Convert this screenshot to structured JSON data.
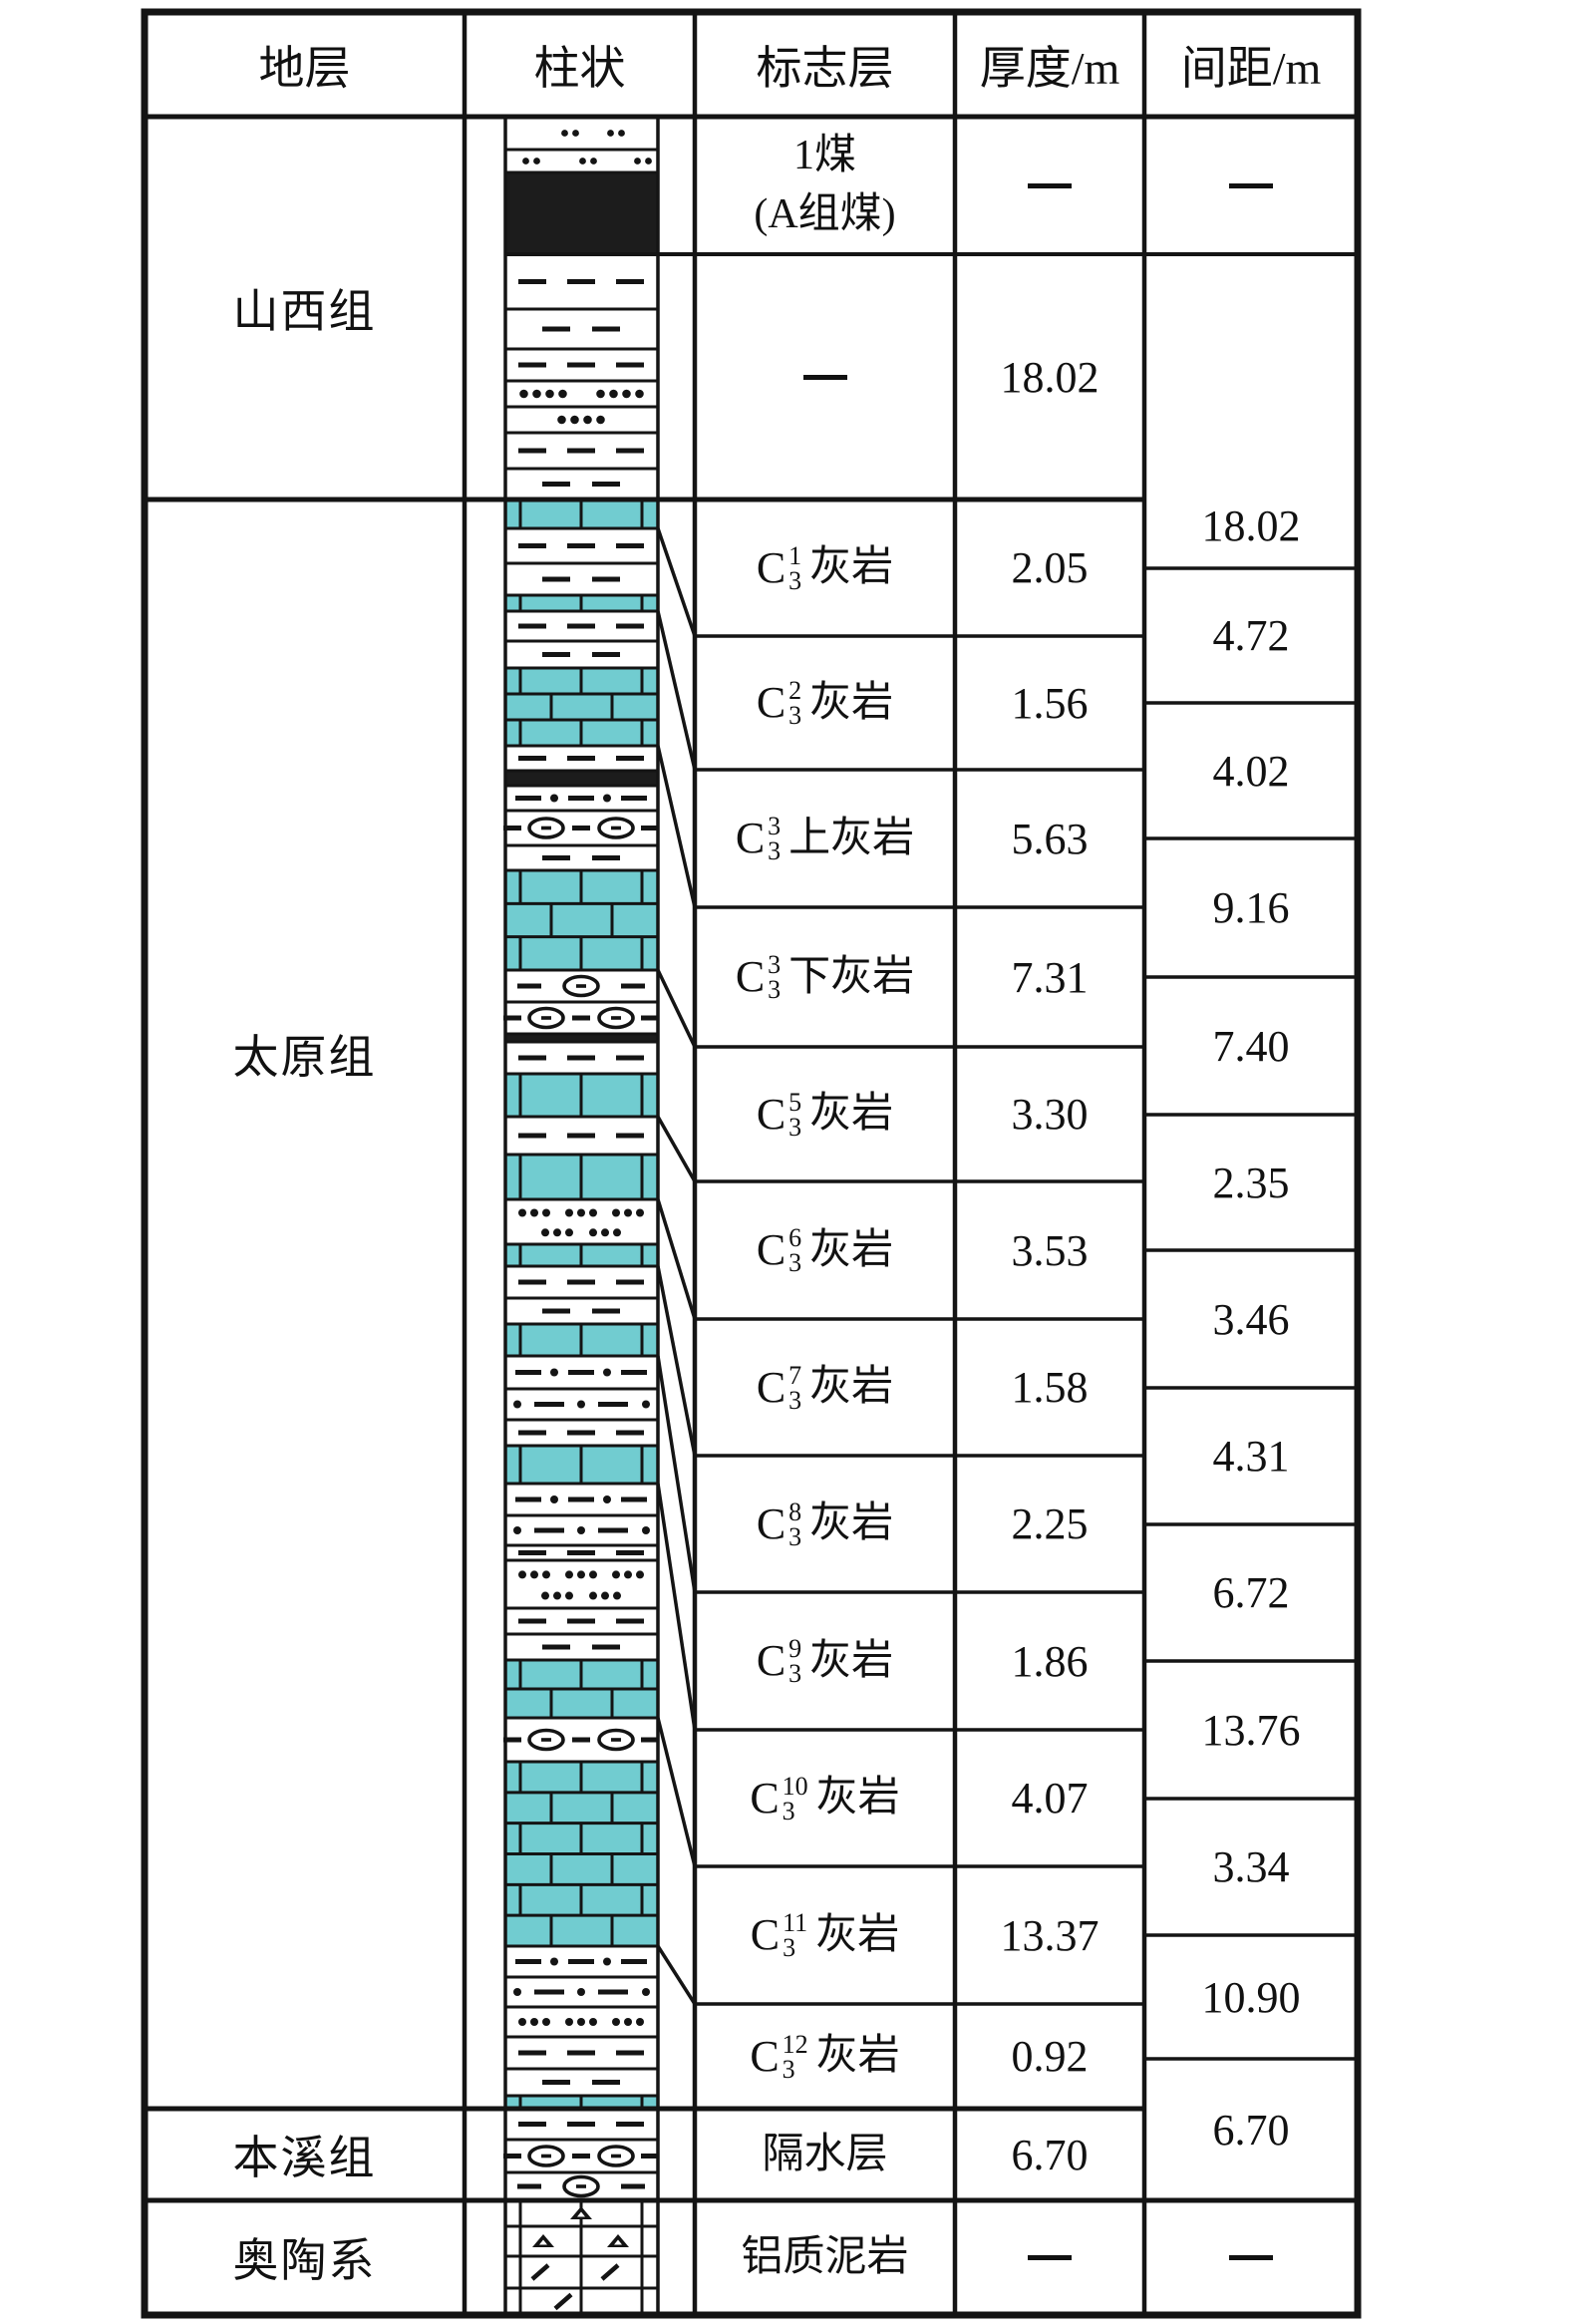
{
  "header": {
    "stratum": "地层",
    "column": "柱状",
    "marker_bed": "标志层",
    "thickness": "厚度/m",
    "spacing": "间距/m"
  },
  "colors": {
    "limestone_fill": "#71ccd0",
    "coal_fill": "#1c1c1c",
    "line": "#141414",
    "background": "#ffffff"
  },
  "chart_data": {
    "type": "stratigraphic-column-table",
    "formations": [
      {
        "name": "山西组"
      },
      {
        "name": "太原组"
      },
      {
        "name": "本溪组"
      },
      {
        "name": "奥陶系"
      }
    ],
    "marker_rows": [
      {
        "marker": "1煤",
        "marker_line2": "(A组煤)",
        "thickness_m": "—"
      },
      {
        "marker": "—",
        "thickness_m": "18.02"
      },
      {
        "c_sup": "1",
        "c_sub": "3",
        "marker": "灰岩",
        "thickness_m": "2.05"
      },
      {
        "c_sup": "2",
        "c_sub": "3",
        "marker": "灰岩",
        "thickness_m": "1.56"
      },
      {
        "c_sup": "3",
        "c_sub": "3",
        "marker": "上灰岩",
        "thickness_m": "5.63"
      },
      {
        "c_sup": "3",
        "c_sub": "3",
        "marker": "下灰岩",
        "thickness_m": "7.31"
      },
      {
        "c_sup": "5",
        "c_sub": "3",
        "marker": "灰岩",
        "thickness_m": "3.30"
      },
      {
        "c_sup": "6",
        "c_sub": "3",
        "marker": "灰岩",
        "thickness_m": "3.53"
      },
      {
        "c_sup": "7",
        "c_sub": "3",
        "marker": "灰岩",
        "thickness_m": "1.58"
      },
      {
        "c_sup": "8",
        "c_sub": "3",
        "marker": "灰岩",
        "thickness_m": "2.25"
      },
      {
        "c_sup": "9",
        "c_sub": "3",
        "marker": "灰岩",
        "thickness_m": "1.86"
      },
      {
        "c_sup": "10",
        "c_sub": "3",
        "marker": "灰岩",
        "thickness_m": "4.07"
      },
      {
        "c_sup": "11",
        "c_sub": "3",
        "marker": "灰岩",
        "thickness_m": "13.37"
      },
      {
        "c_sup": "12",
        "c_sub": "3",
        "marker": "灰岩",
        "thickness_m": "0.92"
      },
      {
        "marker": "隔水层",
        "thickness_m": "6.70"
      },
      {
        "marker": "铝质泥岩",
        "thickness_m": "—"
      }
    ],
    "spacing_m": [
      "—",
      "18.02",
      "4.72",
      "4.02",
      "9.16",
      "7.40",
      "2.35",
      "3.46",
      "4.31",
      "6.72",
      "13.76",
      "3.34",
      "10.90",
      "6.70",
      "—"
    ],
    "lithology_layers": [
      {
        "type": "sandstone-dotpair-2",
        "from": 117,
        "to": 150
      },
      {
        "type": "sandstone-dotpair-3",
        "from": 150,
        "to": 173
      },
      {
        "type": "coal",
        "from": 173,
        "to": 255
      },
      {
        "type": "mudstone-3dash",
        "from": 255,
        "to": 310
      },
      {
        "type": "mudstone-2dash",
        "from": 310,
        "to": 350
      },
      {
        "type": "mudstone-3dash",
        "from": 350,
        "to": 382
      },
      {
        "type": "sandstone-4dot-2",
        "from": 382,
        "to": 408
      },
      {
        "type": "sandstone-4dot-center",
        "from": 408,
        "to": 434
      },
      {
        "type": "mudstone-3dash",
        "from": 434,
        "to": 470
      },
      {
        "type": "mudstone-2dash",
        "from": 470,
        "to": 501
      },
      {
        "type": "limestone-brick",
        "from": 501,
        "to": 530
      },
      {
        "type": "mudstone-3dash",
        "from": 530,
        "to": 565
      },
      {
        "type": "mudstone-2dash",
        "from": 565,
        "to": 597
      },
      {
        "type": "limestone-brick",
        "from": 597,
        "to": 613
      },
      {
        "type": "mudstone-3dash",
        "from": 613,
        "to": 643
      },
      {
        "type": "mudstone-2dash",
        "from": 643,
        "to": 670
      },
      {
        "type": "limestone-brick",
        "from": 670,
        "to": 748
      },
      {
        "type": "mudstone-3dash",
        "from": 748,
        "to": 773
      },
      {
        "type": "coal-thin",
        "from": 773,
        "to": 788
      },
      {
        "type": "silty-dashdot",
        "from": 788,
        "to": 813
      },
      {
        "type": "marl-eye-2",
        "from": 813,
        "to": 848
      },
      {
        "type": "mudstone-2dash",
        "from": 848,
        "to": 873
      },
      {
        "type": "limestone-brick",
        "from": 873,
        "to": 973
      },
      {
        "type": "marl-eye-1",
        "from": 973,
        "to": 1005
      },
      {
        "type": "marl-eye-2",
        "from": 1005,
        "to": 1037
      },
      {
        "type": "coal-thin",
        "from": 1037,
        "to": 1045
      },
      {
        "type": "mudstone-3dash",
        "from": 1045,
        "to": 1077
      },
      {
        "type": "limestone-brick",
        "from": 1077,
        "to": 1120
      },
      {
        "type": "mudstone-3dash",
        "from": 1120,
        "to": 1158
      },
      {
        "type": "limestone-brick",
        "from": 1158,
        "to": 1203
      },
      {
        "type": "sandstone-3dot-2row",
        "from": 1203,
        "to": 1248
      },
      {
        "type": "limestone-brick",
        "from": 1248,
        "to": 1270
      },
      {
        "type": "mudstone-3dash",
        "from": 1270,
        "to": 1302
      },
      {
        "type": "mudstone-2dash",
        "from": 1302,
        "to": 1328
      },
      {
        "type": "limestone-brick",
        "from": 1328,
        "to": 1360
      },
      {
        "type": "silty-dashdot",
        "from": 1360,
        "to": 1393
      },
      {
        "type": "silty-dotdash",
        "from": 1393,
        "to": 1424
      },
      {
        "type": "mudstone-3dash",
        "from": 1424,
        "to": 1450
      },
      {
        "type": "limestone-brick",
        "from": 1450,
        "to": 1488
      },
      {
        "type": "silty-dashdot",
        "from": 1488,
        "to": 1520
      },
      {
        "type": "silty-dotdash",
        "from": 1520,
        "to": 1550
      },
      {
        "type": "mudstone-3dash",
        "from": 1550,
        "to": 1565
      },
      {
        "type": "sandstone-3dot-2row",
        "from": 1565,
        "to": 1613
      },
      {
        "type": "mudstone-3dash",
        "from": 1613,
        "to": 1639
      },
      {
        "type": "mudstone-2dash",
        "from": 1639,
        "to": 1665
      },
      {
        "type": "limestone-brick",
        "from": 1665,
        "to": 1723
      },
      {
        "type": "marl-eye-2",
        "from": 1723,
        "to": 1767
      },
      {
        "type": "limestone-brick",
        "from": 1767,
        "to": 1952
      },
      {
        "type": "silty-dashdot",
        "from": 1952,
        "to": 1983
      },
      {
        "type": "silty-dotdash",
        "from": 1983,
        "to": 2013
      },
      {
        "type": "sandstone-3dot-row",
        "from": 2013,
        "to": 2043
      },
      {
        "type": "mudstone-3dash",
        "from": 2043,
        "to": 2075
      },
      {
        "type": "mudstone-2dash",
        "from": 2075,
        "to": 2102
      },
      {
        "type": "limestone-brick",
        "from": 2102,
        "to": 2115
      },
      {
        "type": "mudstone-3dash",
        "from": 2115,
        "to": 2146
      },
      {
        "type": "marl-eye-2",
        "from": 2146,
        "to": 2179
      },
      {
        "type": "marl-eye-1",
        "from": 2179,
        "to": 2207
      },
      {
        "type": "bauxite-brick-1tri",
        "from": 2207,
        "to": 2233
      },
      {
        "type": "bauxite-brick-2tri",
        "from": 2233,
        "to": 2263
      },
      {
        "type": "bauxite-brick-2slash",
        "from": 2263,
        "to": 2295
      },
      {
        "type": "bauxite-brick-1slash",
        "from": 2295,
        "to": 2322
      }
    ]
  }
}
